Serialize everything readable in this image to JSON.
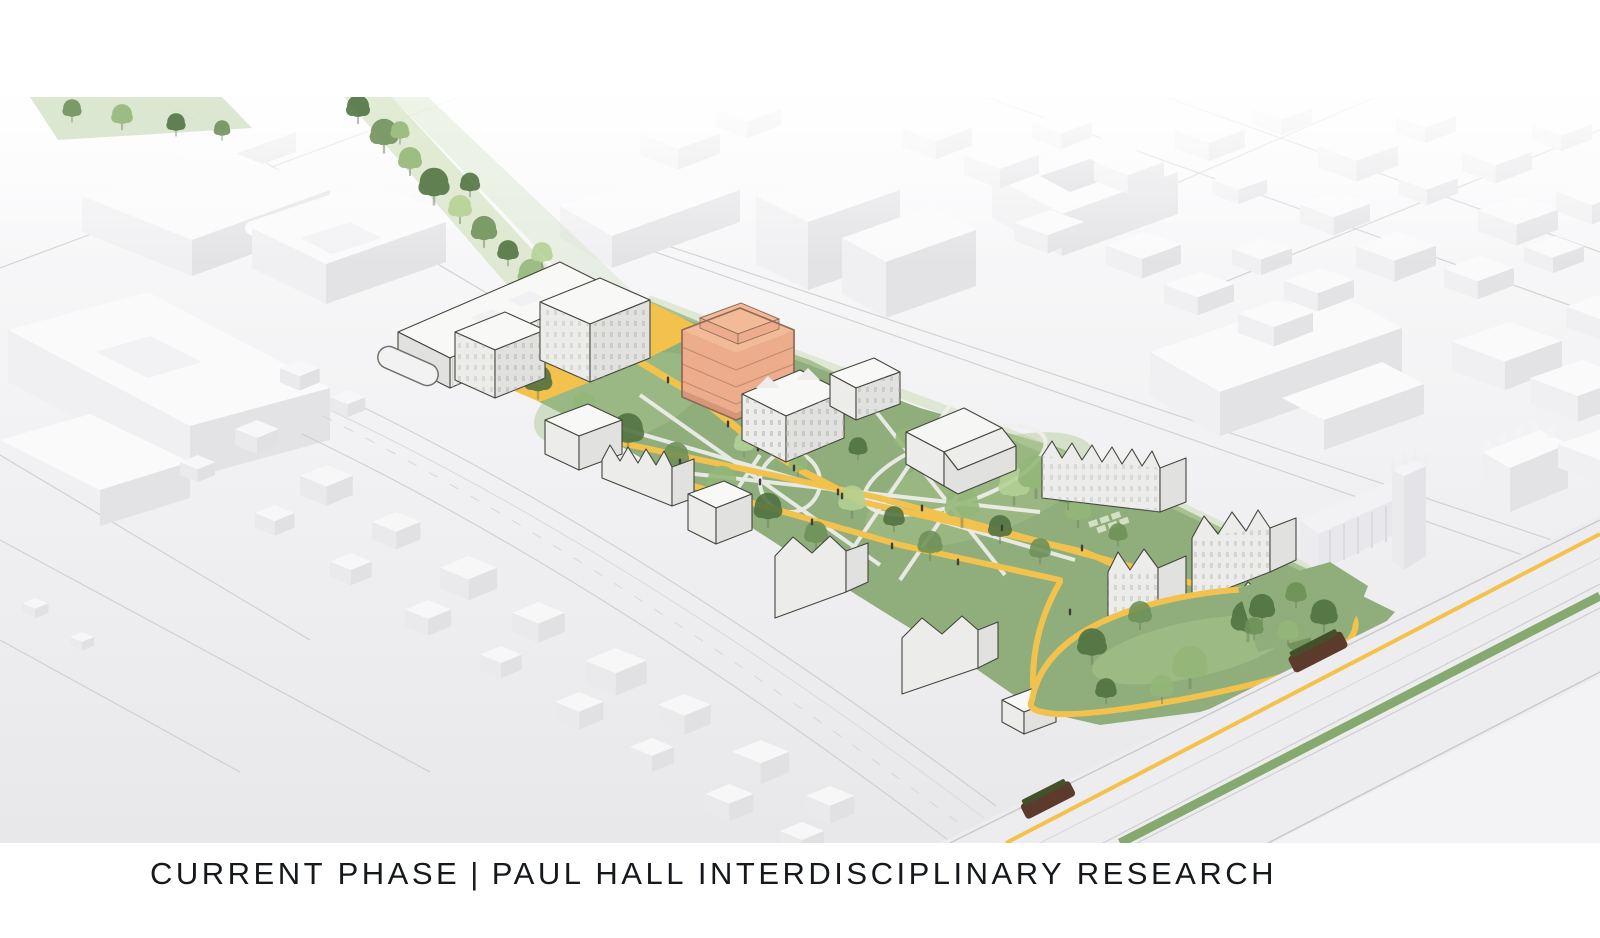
{
  "caption": {
    "phase_label": "CURRENT PHASE",
    "divider": "|",
    "project_label": "PAUL HALL INTERDISCIPLINARY RESEARCH"
  },
  "colors": {
    "pageBg": "#FFFFFF",
    "groundTop": "#FAFAFB",
    "groundBottom": "#E8E8EA",
    "ctxTop": "#FAFAFB",
    "ctxSideL": "#F0F0F2",
    "ctxSideD": "#E3E3E6",
    "focusTop": "#F8F8F7",
    "focusSw": "#ECECEA",
    "focusSe": "#E1E1DF",
    "outline": "#45453F",
    "hlTop": "#F3BA98",
    "hlFace": "#EDAC8B",
    "hlDark": "#C98F74",
    "hlOutline": "#8E6A57",
    "lawn": "#8FAE7B",
    "lawnLight": "#A9C68E",
    "lawnPale": "#C6D9AB",
    "treeDark": "#4F7140",
    "treeMid": "#6E9058",
    "treeLight": "#93B778",
    "treePale": "#B4D195",
    "pathWhite": "#EFEFEC",
    "pathYellow": "#F2C24D",
    "street": "#EDEDEF",
    "curb": "#C9C9CD",
    "median": "#7BA263",
    "tramBody": "#5C3A2C",
    "tramRoof": "#44502A",
    "people": "#3E3E38",
    "caption": "#16191C"
  }
}
